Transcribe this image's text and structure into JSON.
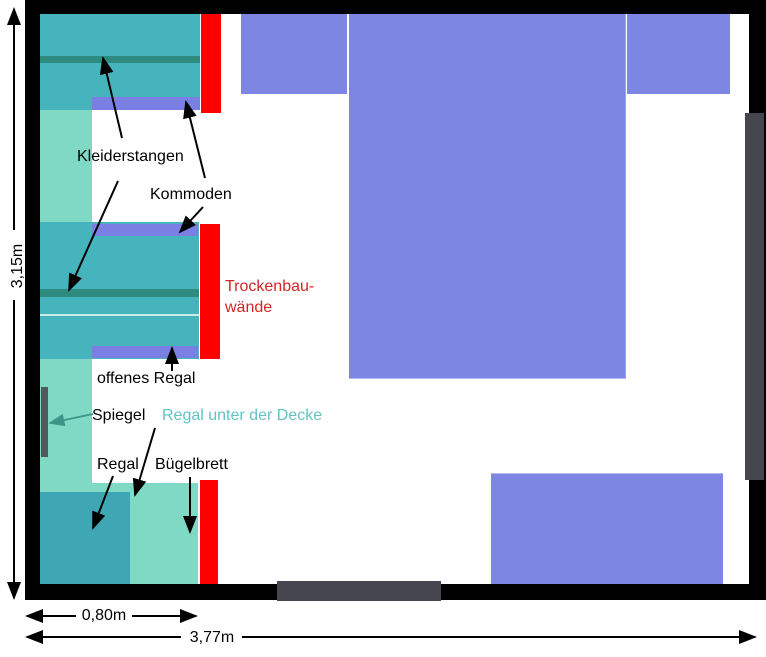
{
  "labels": {
    "kleiderstangen": "Kleiderstangen",
    "kommoden": "Kommoden",
    "trockenbau_line1": "Trockenbau-",
    "trockenbau_line2": "wände",
    "offenes_regal": "offenes Regal",
    "spiegel": "Spiegel",
    "regal_unter_der_decke": "Regal unter der Decke",
    "regal": "Regal",
    "buegelbrett": "Bügelbrett"
  },
  "dimensions": {
    "room_height": "3,15m",
    "closet_depth": "0,80m",
    "room_width": "3,77m"
  },
  "colors": {
    "wall": "#000000",
    "wardrobe_teal": "#45b4bd",
    "shelf_teal_dark": "#3fa6b4",
    "ceiling_shelf_mint": "#7fd9c5",
    "clothes_rail": "#2d8c7f",
    "shelf_line": "#c9ece8",
    "kommode_purple": "#7a80e3",
    "furniture_purple": "#7d86e2",
    "drywall_red": "#ff0000",
    "drywall_text_red": "#d32525",
    "ceiling_shelf_text_teal": "#63c3c5",
    "door_gray": "#45464f",
    "mirror_gray": "#4d5a59",
    "mirror_arrow_teal": "#3c9687"
  }
}
